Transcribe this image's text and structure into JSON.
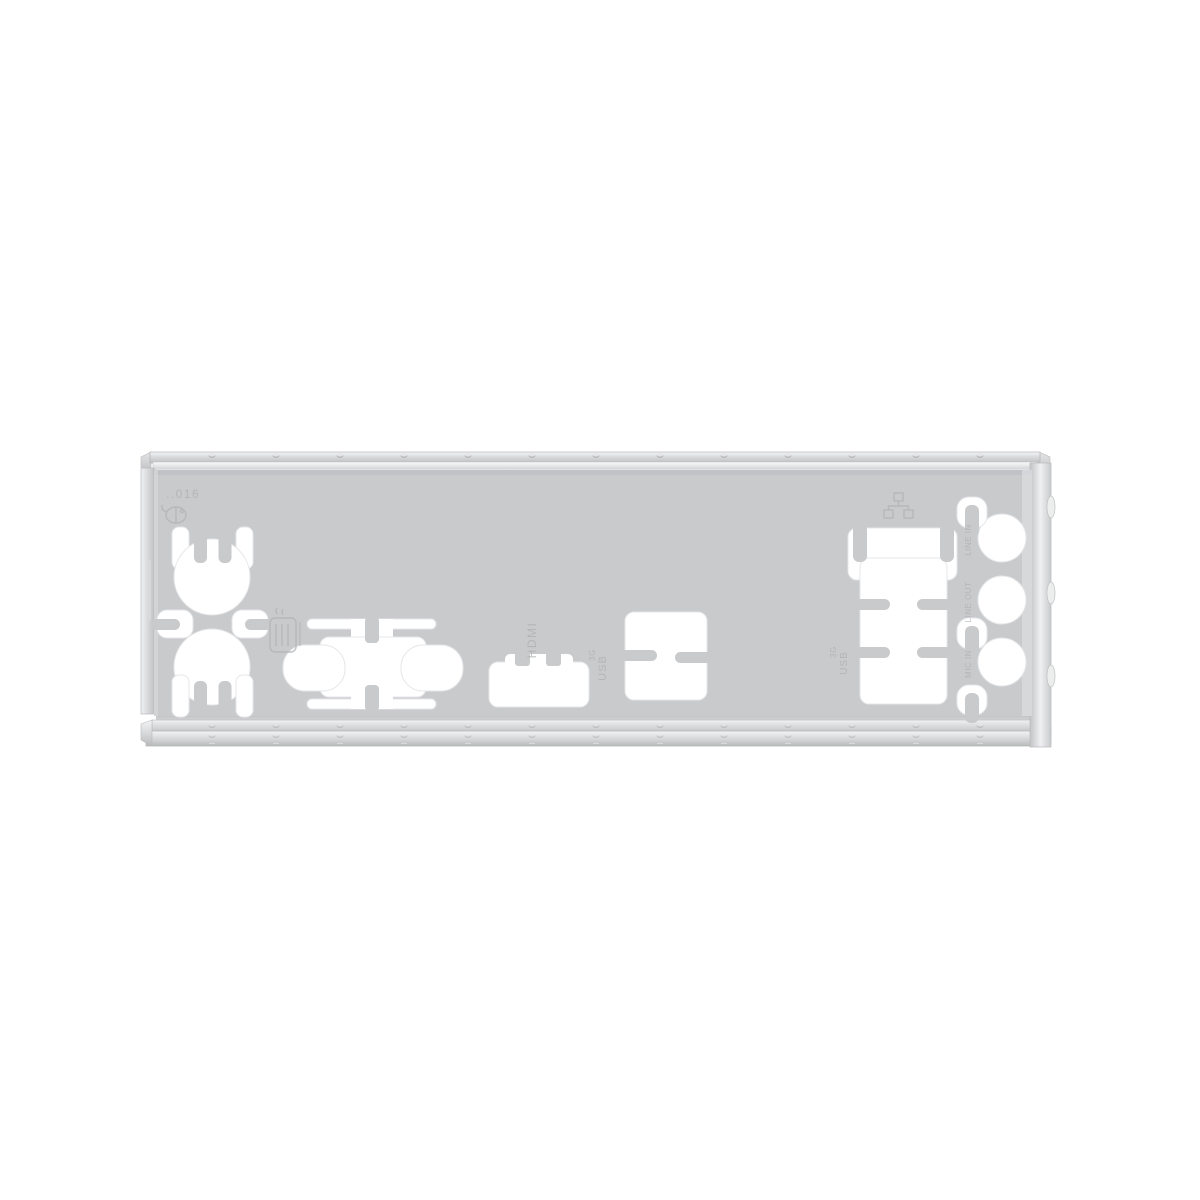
{
  "scene": {
    "description": "Silver metal motherboard rear I/O shield (backplate) photographed on a plain white background",
    "background_color": "#ffffff",
    "plate_color": "#c9cacc",
    "metal_highlight": "#f5f6f7",
    "metal_shadow": "#b4b5b8",
    "cutout_color": "#ffffff"
  },
  "labels": {
    "mold_number": "..016",
    "hdmi": "HDMI",
    "usb_center": "USB",
    "usb_center_gen": "3G",
    "usb_right": "USB",
    "usb_right_gen": "3G",
    "audio_top": "LINE IN",
    "audio_middle": "LINE OUT",
    "audio_bottom": "MIC IN"
  },
  "icons": [
    "mouse-icon",
    "keyboard-icon",
    "lan-icon"
  ],
  "cutouts": [
    "ps2-mouse-cutout",
    "ps2-keyboard-cutout",
    "retention-clip-left",
    "retention-clip-right",
    "dvi-cutout",
    "hdmi-cutout",
    "dual-usb-cutout",
    "lan-usb-cutout",
    "audio-jack-top",
    "audio-jack-middle",
    "audio-jack-bottom"
  ]
}
